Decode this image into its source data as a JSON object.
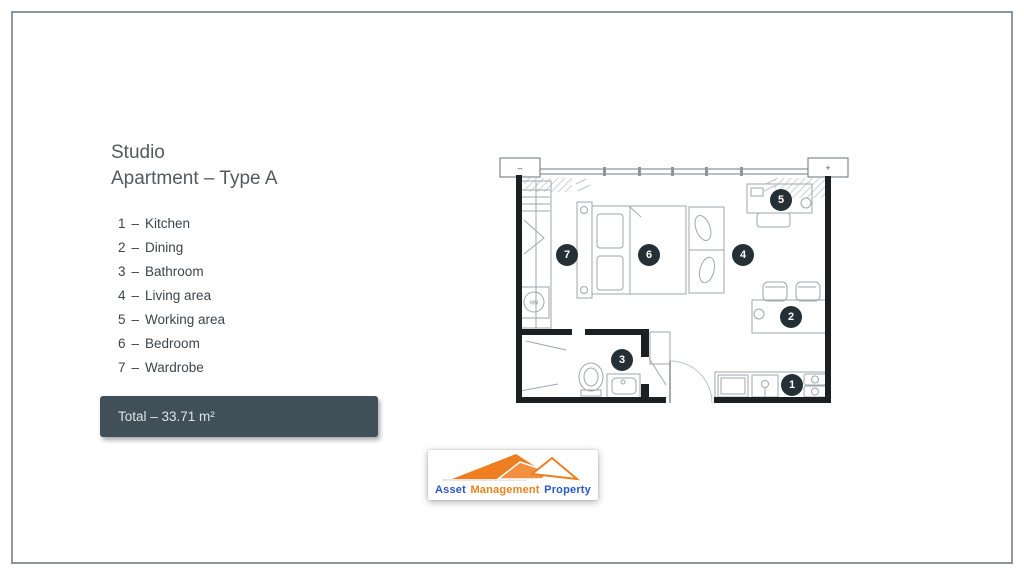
{
  "slide": {
    "title_line1": "Studio",
    "title_line2": "Apartment – Type A",
    "legend": {
      "sep": "–",
      "items": [
        {
          "num": "1",
          "label": "Kitchen"
        },
        {
          "num": "2",
          "label": "Dining"
        },
        {
          "num": "3",
          "label": "Bathroom"
        },
        {
          "num": "4",
          "label": "Living area"
        },
        {
          "num": "5",
          "label": "Working area"
        },
        {
          "num": "6",
          "label": "Bedroom"
        },
        {
          "num": "7",
          "label": "Wardrobe"
        }
      ]
    },
    "total": "Total – 33.71 m²"
  },
  "plan": {
    "wm_label": "WM",
    "left_cap": "–",
    "right_cap": "+"
  },
  "logo": {
    "words": [
      {
        "text": "Asset",
        "color": "#2b57c8"
      },
      {
        "text": "Management",
        "color": "#e8821e"
      },
      {
        "text": "Property",
        "color": "#2b57c8"
      }
    ]
  },
  "colors": {
    "marker_bg": "#242f36",
    "total_bg": "#415058",
    "frame_border": "#8f979c",
    "wall": "#1c2022",
    "furniture_line": "#a0a7ab",
    "logo_orange": "#e8821e",
    "logo_blue": "#2b57c8"
  }
}
